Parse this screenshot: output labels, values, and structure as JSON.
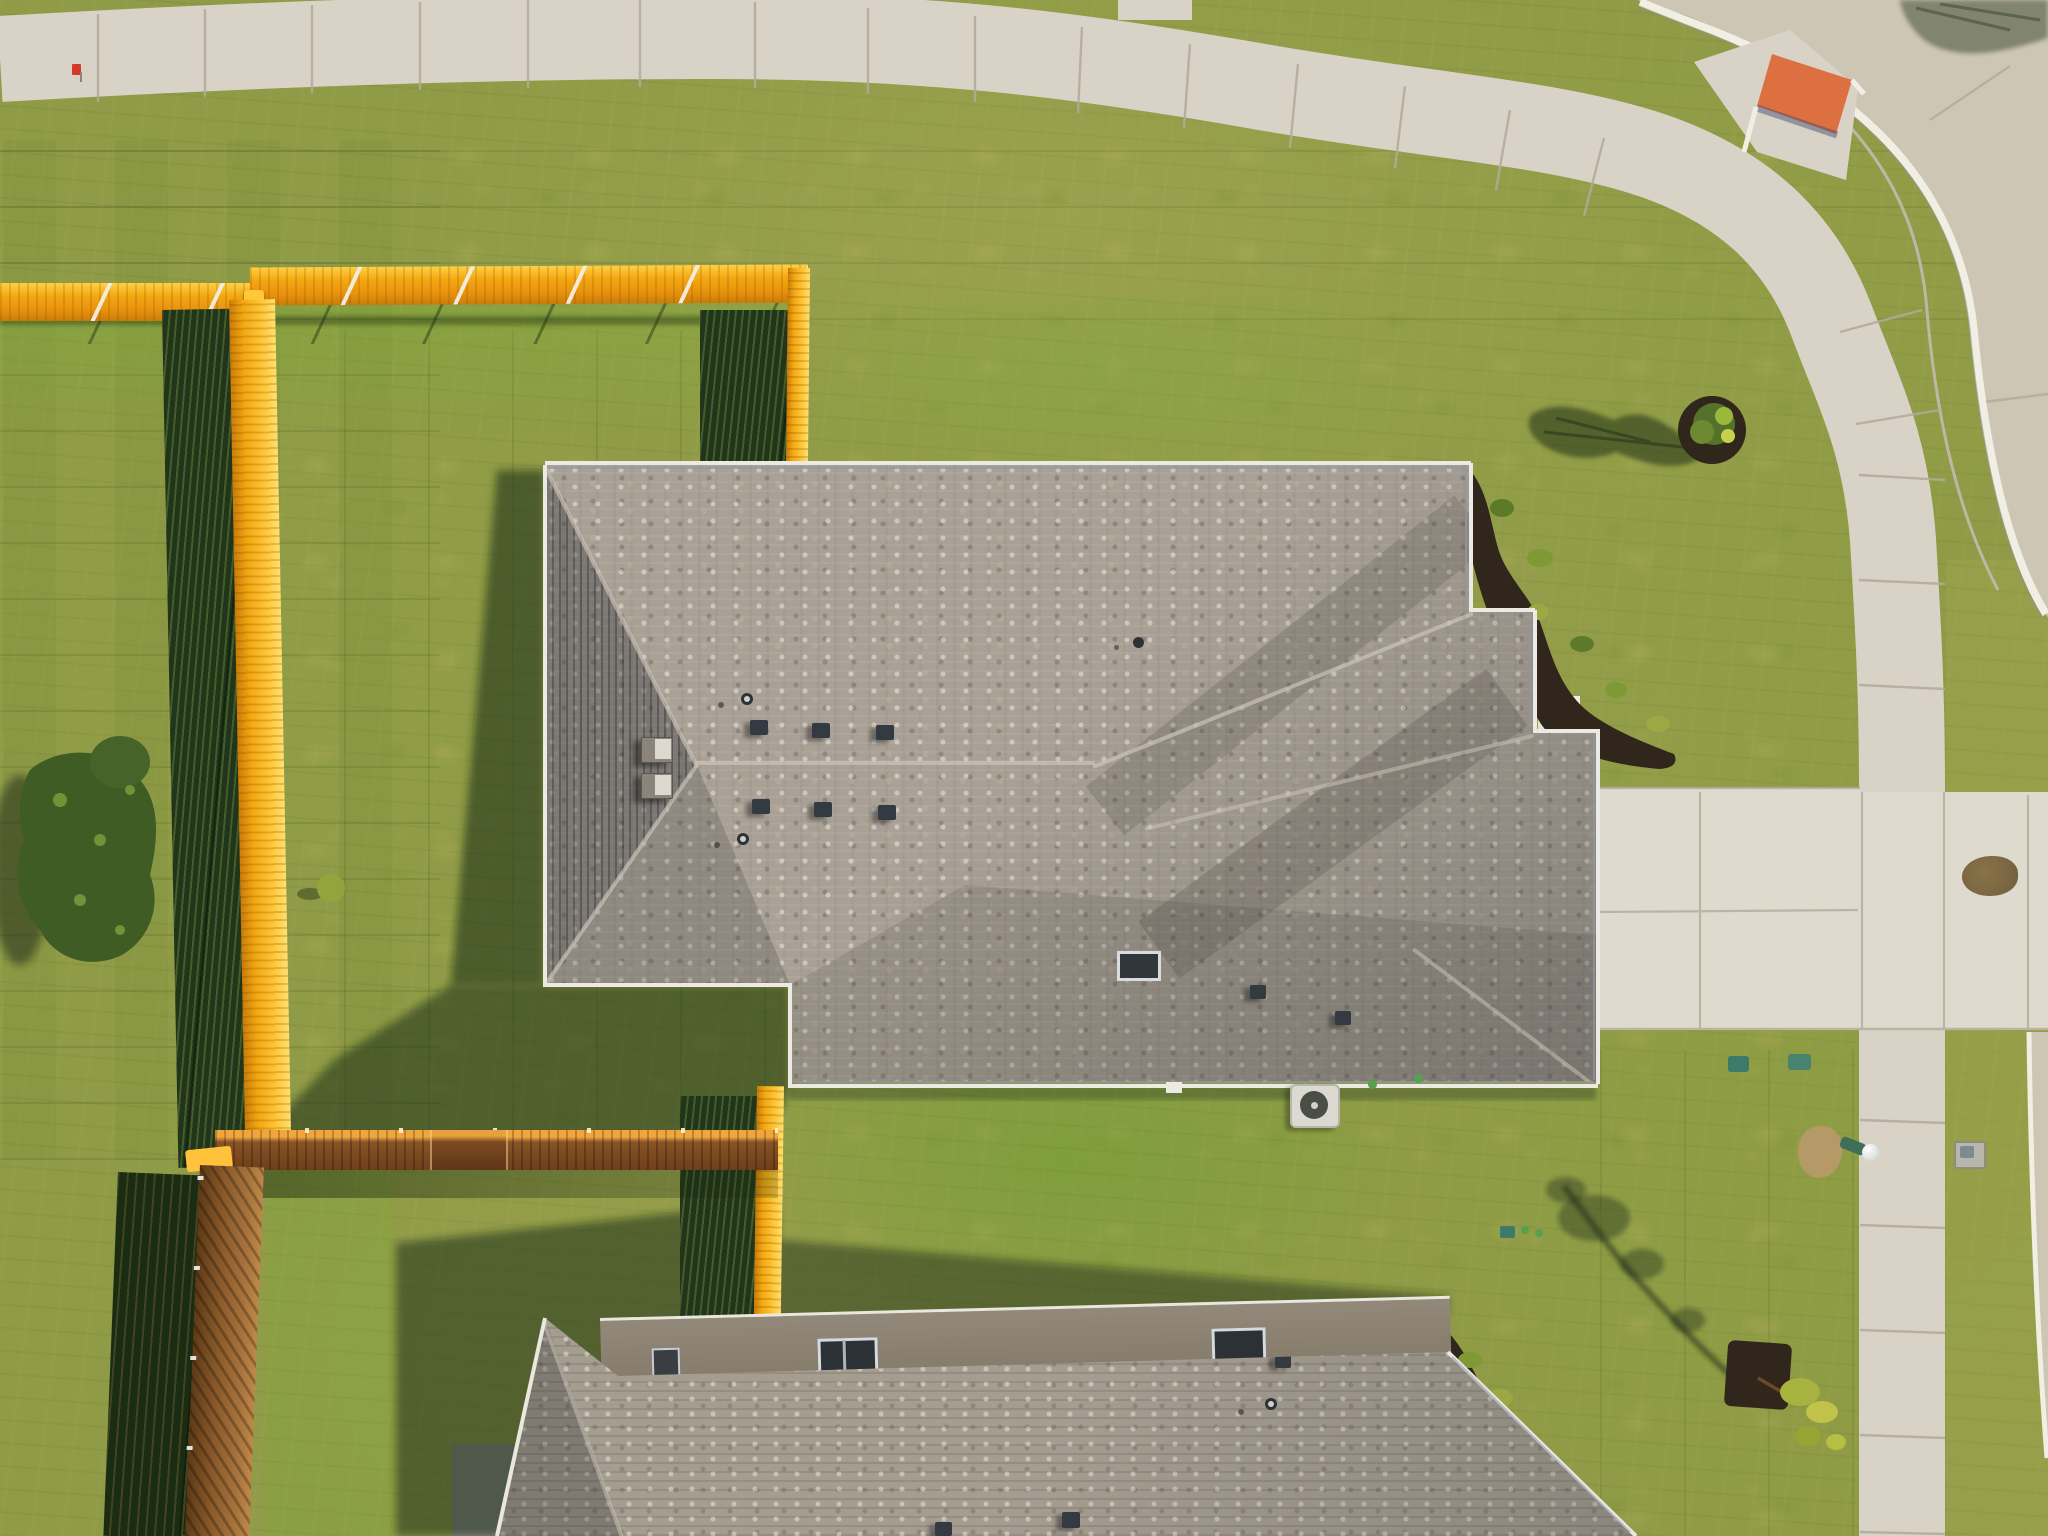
{
  "scene": {
    "type": "aerial-drone-photo",
    "description": "Top-down aerial view of a new suburban house with gray shingle hip roof, bright orange wooden privacy fence around the back yard, new sod lawn, curving concrete sidewalk and street at the corner, driveway with front walkway, and a second house roof at the bottom",
    "time_of_day": "low morning sun, long shadows cast to the west"
  },
  "objects": {
    "lawn": {
      "label": "new sod lawn in mixed olive and green tones"
    },
    "street": {
      "label": "concrete street curving around the top right corner"
    },
    "curb": {
      "label": "white concrete curb"
    },
    "sidewalk": {
      "label": "concrete sidewalk along top edge curving down the right side"
    },
    "curb_ramp": {
      "label": "corner curb ramp with orange tactile warning pad"
    },
    "driveway": {
      "label": "concrete driveway on the right side"
    },
    "walkway": {
      "label": "front walkway and porch steps"
    },
    "house1": {
      "label": "main house with gray composition shingle hip roof"
    },
    "house2": {
      "label": "second house roof at bottom with taupe wall and windows"
    },
    "fence_top": {
      "label": "orange stained wood fence, north property line"
    },
    "fence_left": {
      "label": "orange stained wood fence, west property line"
    },
    "fence_right_upper": {
      "label": "orange fence from north line to house"
    },
    "fence_mid": {
      "label": "orange fence behind house with gate"
    },
    "fence_right_lower": {
      "label": "orange fence between houses"
    },
    "fence_front": {
      "label": "brown cedar fence between front yards"
    },
    "tree_corner": {
      "label": "young shrub in mulch ring near street corner"
    },
    "tree_front": {
      "label": "young sapling in mulch square in front yard"
    },
    "tree_back": {
      "label": "trees and shrubs along back fence"
    },
    "garden_beds": {
      "label": "black mulch planting beds with small shrubs"
    },
    "lamp_post": {
      "label": "green yard lamp post with white globe"
    },
    "ac_unit": {
      "label": "air conditioner condenser unit"
    },
    "utility_boxes": {
      "label": "green irrigation utility boxes"
    },
    "water_meter": {
      "label": "gray water meter box in parkway"
    },
    "marker_flag": {
      "label": "small red utility flag near sidewalk"
    },
    "roof_vents": {
      "label": "roof vents and plumbing pipes with shadows"
    }
  },
  "palette": {
    "grass_base": "#8f9b46",
    "grass_bright": "#7fa437",
    "grass_olive": "#9aa250",
    "grass_shadow": "#223a19",
    "sod_tan": "#b3ab62",
    "concrete_walk": "#d8d3c6",
    "concrete_street": "#cdc6b5",
    "concrete_drive": "#dedacd",
    "concrete_joint": "#b2ab9b",
    "curb_white": "#f1eee3",
    "fence_orange": "#f3a812",
    "fence_orange_light": "#ffd045",
    "fence_orange_dark": "#c97c08",
    "fence_brown": "#8a5a2a",
    "fence_brown_dark": "#5e3a16",
    "roof_base": "#a9a195",
    "roof_dark": "#6f6c66",
    "roof_light": "#cfc8bb",
    "roof2_base": "#a59d90",
    "fascia": "#eceae2",
    "fascia_shadow": "#8d99ad",
    "mulch": "#30261b",
    "plant_green": "#5d7a2b",
    "plant_yellow": "#9aa944",
    "pad_orange": "#dd7040",
    "wall_taupe": "#8f8575",
    "window_dark": "#2c3136",
    "window_frame": "#d6dadf",
    "ac_white": "#dcd9d0",
    "lamp_green": "#3f6e5a",
    "lamp_globe": "#f2f4f0",
    "util_teal": "#3d7a6a",
    "meter_gray": "#b9b6ac",
    "dirt_tan": "#b59a68",
    "flag_red": "#d23b2a"
  }
}
